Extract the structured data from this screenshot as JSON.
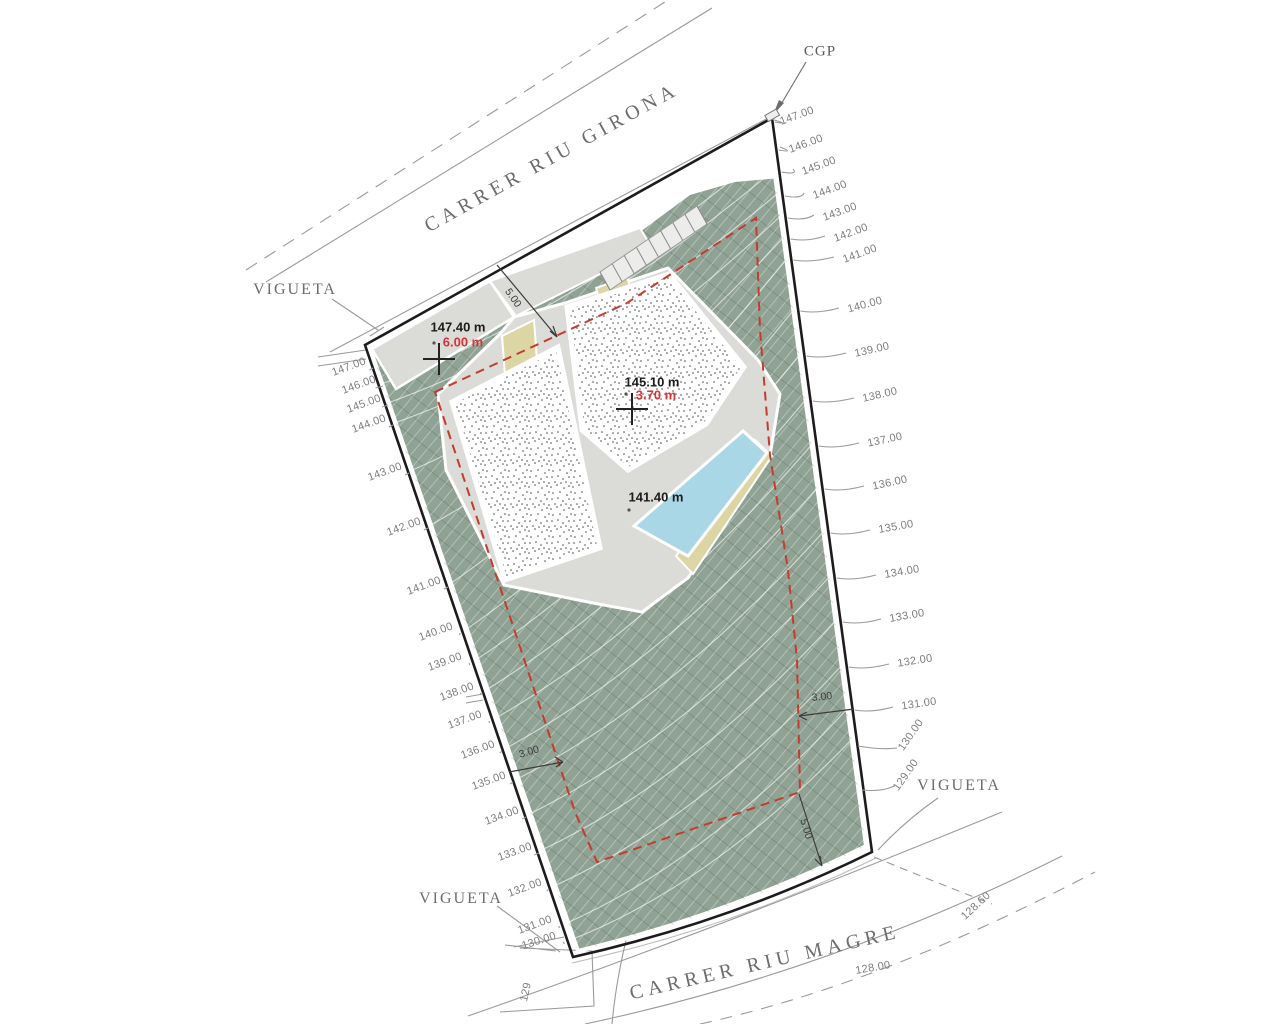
{
  "streets": {
    "top": "CARRER RIU GIRONA",
    "bottom": "CARRER RIU MAGRE"
  },
  "annotations": {
    "cgp": "CGP",
    "vigueta_top_left": "VIGUETA",
    "vigueta_bottom_left": "VIGUETA",
    "vigueta_right": "VIGUETA"
  },
  "spot_elevations": [
    {
      "elevation": "147.40 m",
      "offset": "6.00 m"
    },
    {
      "elevation": "145.10 m",
      "offset": "3.70 m"
    },
    {
      "elevation": "141.40 m",
      "offset": ""
    }
  ],
  "dimensions": {
    "top_setback": "5.00",
    "left_setback": "3.00",
    "right_setback": "3.00",
    "bottom_setback": "5.00"
  },
  "contours": {
    "left": [
      "147.00",
      "146.00",
      "145.00",
      "144.00",
      "143.00",
      "142.00",
      "141.00",
      "140.00",
      "139.00",
      "138.00",
      "137.00",
      "136.00",
      "135.00",
      "134.00",
      "133.00",
      "132.00",
      "131.00",
      "130.00",
      "129"
    ],
    "right": [
      "147.00",
      "146.00",
      "145.00",
      "144.00",
      "143.00",
      "142.00",
      "141.00",
      "140.00",
      "139.00",
      "138.00",
      "137.00",
      "136.00",
      "135.00",
      "134.00",
      "133.00",
      "132.00",
      "131.00",
      "130.00",
      "129.00"
    ],
    "street_bottom": [
      "128.60",
      "128.00"
    ]
  },
  "colors": {
    "terrain_green": "#8fa294",
    "pool_blue": "#a9d7e6",
    "setback_red": "#c43c2e",
    "path_khaki": "#dcd6a4",
    "platform_grey": "#dbdbd8"
  }
}
